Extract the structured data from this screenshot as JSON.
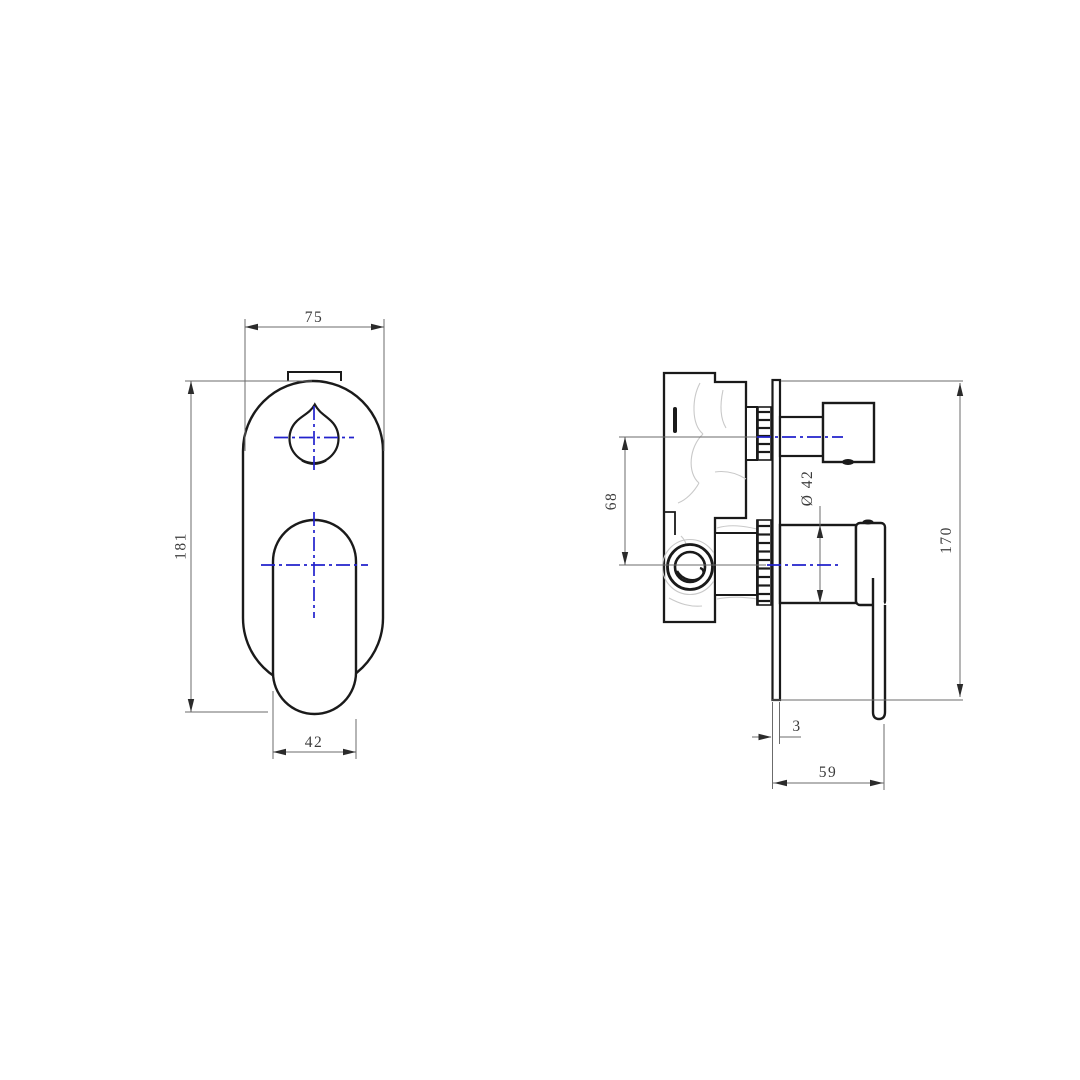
{
  "drawing": {
    "kind": "technical-drawing",
    "subject": "wall-mounted shower mixer with diverter, two orthographic views",
    "views": {
      "front": {
        "label": "front view",
        "dimensions": {
          "plate_width": "75",
          "overall_height": "181",
          "handle_width": "42"
        }
      },
      "side": {
        "label": "side view",
        "dimensions": {
          "center_spacing": "68",
          "cartridge_diameter": "Ø 42",
          "plate_height": "170",
          "plate_thickness": "3",
          "projection": "59"
        }
      }
    },
    "colors": {
      "outline": "#1a1a1a",
      "dimension_line": "#6b6b6b",
      "dimension_text": "#3c3c3c",
      "centerline_blue": "#2222cc",
      "shading_gray": "#c9c9c9",
      "background": "#ffffff"
    }
  }
}
